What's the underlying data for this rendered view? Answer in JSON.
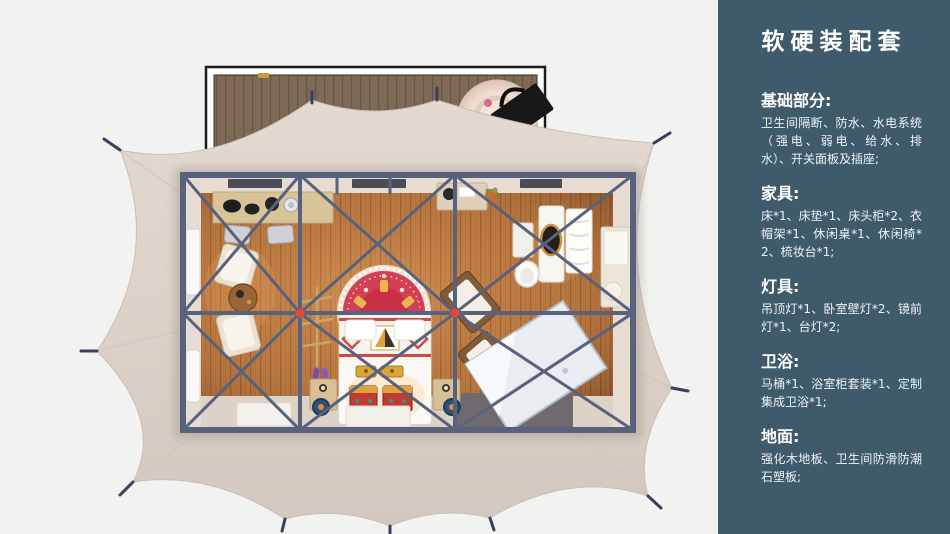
{
  "page": {
    "background": "#f2f2f1"
  },
  "sidebar": {
    "background": "#3e5a6b",
    "text_color": "#ffffff",
    "title": "软硬装配套",
    "sections": [
      {
        "heading": "基础部分:",
        "body": "卫生间隔断、防水、水电系统（强电、弱电、给水、排水）、开关面板及插座;"
      },
      {
        "heading": "家具:",
        "body": "床*1、床垫*1、床头柜*2、衣帽架*1、休闲桌*1、休闲椅*2、梳妆台*1;"
      },
      {
        "heading": "灯具:",
        "body": "吊顶灯*1、卧室壁灯*2、镜前灯*1、台灯*2;"
      },
      {
        "heading": "卫浴:",
        "body": "马桶*1、浴室柜套装*1、定制集成卫浴*1;"
      },
      {
        "heading": "地面:",
        "body": "强化木地板、卫生间防滑防潮石塑板;"
      }
    ]
  },
  "illustration": {
    "subject": "glamping-tent-top-view-render",
    "colors": {
      "canopy": "#dcd2c9",
      "frame": "#59627c",
      "wood_floor": "#b5763f",
      "deck_wood": "#7d6955",
      "rug_red": "#d14054",
      "hub_red": "#e0483c"
    }
  }
}
